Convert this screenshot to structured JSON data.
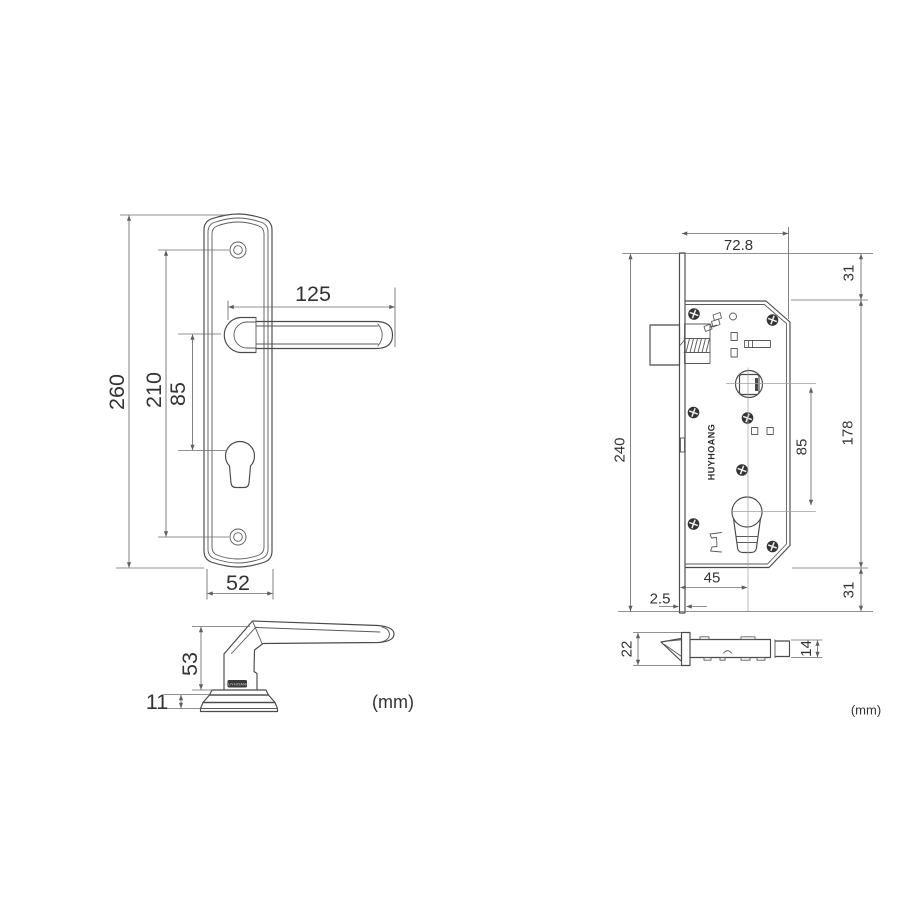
{
  "drawing": {
    "unit_note": "(mm)",
    "handle_front": {
      "overall_height": "260",
      "screw_spacing": "210",
      "handle_to_cylinder": "85",
      "handle_length": "125",
      "plate_width": "52"
    },
    "handle_side": {
      "handle_height": "53",
      "base_thickness": "11",
      "brand": "HUYHOANG"
    },
    "lock_front": {
      "case_width": "72.8",
      "top_margin": "31",
      "case_height": "178",
      "follower_to_cylinder": "85",
      "faceplate_height": "240",
      "backset": "45",
      "faceplate_thickness": "2.5",
      "bottom_margin": "31",
      "brand": "HUYHOANG"
    },
    "lock_top": {
      "faceplate_width": "22",
      "case_thickness": "14"
    }
  }
}
